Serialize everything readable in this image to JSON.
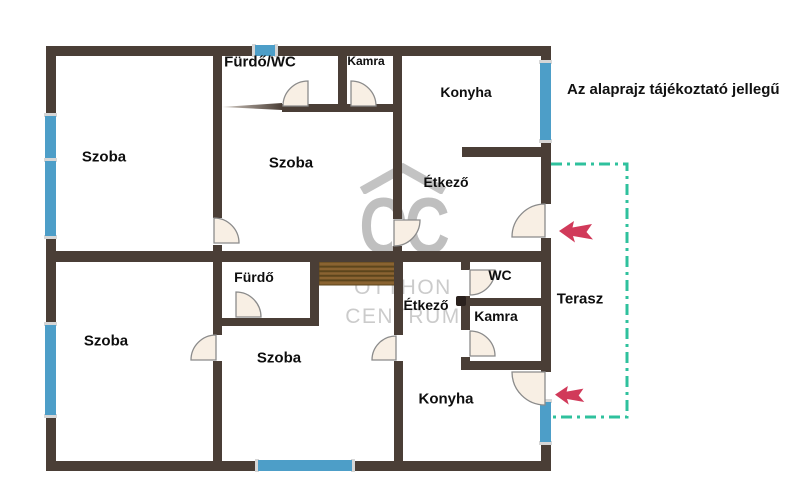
{
  "canvas": {
    "width": 808,
    "height": 500,
    "background": "#ffffff"
  },
  "disclaimer": "Az alaprajz tájékoztató jellegű",
  "watermark": {
    "monogram": "OC",
    "line1": "OTTHON",
    "line2": "CENTRUM"
  },
  "colors": {
    "wall": "#4a3e36",
    "window": "#4d9ec8",
    "window_cap": "#d6d6d6",
    "door_fill": "#f8efe4",
    "door_stroke": "#8b8b8b",
    "terrace": "#2fc19d",
    "arrow": "#d13a5a",
    "stairs": "#8a6331",
    "stairs_line": "#5c451c",
    "watermark": "#b9b9b9",
    "label": "#0e0e0e",
    "dot": "#2a211d"
  },
  "plan": {
    "walls": [
      {
        "id": "outer-top",
        "x": 46,
        "y": 46,
        "w": 505,
        "h": 10
      },
      {
        "id": "outer-bottom",
        "x": 46,
        "y": 461,
        "w": 505,
        "h": 10
      },
      {
        "id": "outer-left",
        "x": 46,
        "y": 46,
        "w": 10,
        "h": 425
      },
      {
        "id": "outer-right",
        "x": 541,
        "y": 46,
        "w": 10,
        "h": 425
      },
      {
        "id": "mid",
        "x": 46,
        "y": 251,
        "w": 505,
        "h": 11
      },
      {
        "id": "upper-left-room-divider",
        "x": 213,
        "y": 56,
        "w": 9,
        "h": 195
      },
      {
        "id": "bath-bottom",
        "x": 282,
        "y": 104,
        "w": 120,
        "h": 8
      },
      {
        "id": "bath-kamra-divider",
        "x": 338,
        "y": 56,
        "w": 9,
        "h": 56
      },
      {
        "id": "upper-right-room-divider",
        "x": 393,
        "y": 56,
        "w": 9,
        "h": 195
      },
      {
        "id": "konyha-etkezo-stub",
        "x": 462,
        "y": 147,
        "w": 89,
        "h": 10
      },
      {
        "id": "lower-left-room-divider",
        "x": 213,
        "y": 262,
        "w": 9,
        "h": 199
      },
      {
        "id": "furdo-right",
        "x": 310,
        "y": 262,
        "w": 9,
        "h": 64
      },
      {
        "id": "furdo-bottom",
        "x": 213,
        "y": 318,
        "w": 106,
        "h": 8
      },
      {
        "id": "lower-right-room-divider",
        "x": 394,
        "y": 262,
        "w": 9,
        "h": 199
      },
      {
        "id": "wc-kamra-left",
        "x": 461,
        "y": 262,
        "w": 9,
        "h": 108
      },
      {
        "id": "wc-kamra-divider",
        "x": 461,
        "y": 298,
        "w": 80,
        "h": 8
      },
      {
        "id": "kamra-bottom",
        "x": 461,
        "y": 361,
        "w": 90,
        "h": 9
      }
    ],
    "openings": [
      {
        "id": "etkezo-terrace-door-gap",
        "x": 540,
        "y": 204,
        "w": 12,
        "h": 34
      },
      {
        "id": "konyha-terrace-door-gap",
        "x": 540,
        "y": 372,
        "w": 12,
        "h": 30
      },
      {
        "id": "upper-szoba-door-gap",
        "x": 212,
        "y": 218,
        "w": 11,
        "h": 27
      },
      {
        "id": "etkezo-door-gap",
        "x": 392,
        "y": 219,
        "w": 11,
        "h": 27
      },
      {
        "id": "lower-left-szoba-door-gap",
        "x": 212,
        "y": 335,
        "w": 11,
        "h": 26
      },
      {
        "id": "lower-mid-szoba-door-gap",
        "x": 393,
        "y": 335,
        "w": 11,
        "h": 26
      },
      {
        "id": "wc-door-gap",
        "x": 460,
        "y": 270,
        "w": 11,
        "h": 26
      },
      {
        "id": "kamra-lower-door-gap",
        "x": 460,
        "y": 330,
        "w": 11,
        "h": 27
      }
    ],
    "windows": [
      {
        "id": "window-top",
        "x": 255,
        "y": 45,
        "w": 20,
        "h": 11,
        "dir": "h"
      },
      {
        "id": "window-left-1",
        "x": 45,
        "y": 116,
        "w": 11,
        "h": 43,
        "dir": "v"
      },
      {
        "id": "window-left-2",
        "x": 45,
        "y": 161,
        "w": 11,
        "h": 75,
        "dir": "v"
      },
      {
        "id": "window-left-3",
        "x": 45,
        "y": 325,
        "w": 11,
        "h": 90,
        "dir": "v"
      },
      {
        "id": "window-right-1",
        "x": 540,
        "y": 63,
        "w": 11,
        "h": 77,
        "dir": "v"
      },
      {
        "id": "window-right-2",
        "x": 540,
        "y": 402,
        "w": 11,
        "h": 40,
        "dir": "v"
      },
      {
        "id": "window-bottom",
        "x": 258,
        "y": 460,
        "w": 94,
        "h": 11,
        "dir": "h"
      }
    ],
    "doors": [
      {
        "id": "furdo-wc-top",
        "hx": 308,
        "hy": 106,
        "r": 25,
        "a1": 180,
        "a2": 270
      },
      {
        "id": "kamra-top",
        "hx": 351,
        "hy": 106,
        "r": 25,
        "a1": 270,
        "a2": 360
      },
      {
        "id": "upper-szoba",
        "hx": 214,
        "hy": 243,
        "r": 25,
        "a1": 270,
        "a2": 360
      },
      {
        "id": "etkezo-upper",
        "hx": 394,
        "hy": 220,
        "r": 26,
        "a1": 0,
        "a2": 90
      },
      {
        "id": "etkezo-terrace",
        "hx": 545,
        "hy": 237,
        "r": 33,
        "a1": 180,
        "a2": 270
      },
      {
        "id": "lower-left-szoba",
        "hx": 216,
        "hy": 360,
        "r": 25,
        "a1": 180,
        "a2": 270
      },
      {
        "id": "furdo-lower",
        "hx": 236,
        "hy": 317,
        "r": 25,
        "a1": 270,
        "a2": 360
      },
      {
        "id": "lower-mid-szoba",
        "hx": 396,
        "hy": 360,
        "r": 24,
        "a1": 180,
        "a2": 270
      },
      {
        "id": "wc",
        "hx": 470,
        "hy": 270,
        "r": 25,
        "a1": 0,
        "a2": 90
      },
      {
        "id": "kamra-lower",
        "hx": 470,
        "hy": 356,
        "r": 25,
        "a1": 270,
        "a2": 360
      },
      {
        "id": "konyha-terrace",
        "hx": 545,
        "hy": 372,
        "r": 33,
        "a1": 90,
        "a2": 180
      }
    ],
    "stairs": {
      "x": 319,
      "y": 262,
      "w": 76,
      "h": 23,
      "slats": 4
    },
    "post_dot": {
      "x": 456,
      "y": 296,
      "w": 10,
      "h": 10
    },
    "taper_line": {
      "x1": 222,
      "y1": 107,
      "x2": 282,
      "y2": 103,
      "y3": 110
    },
    "terrace": {
      "points": "551,164 627,164 627,417 551,417",
      "dash": "11 5 3 5"
    },
    "arrows": [
      {
        "id": "entrance-arrow-upper",
        "x": 559,
        "y": 221,
        "w": 36,
        "h": 22
      },
      {
        "id": "entrance-arrow-lower",
        "x": 555,
        "y": 386,
        "w": 31,
        "h": 19
      }
    ],
    "rooms": [
      {
        "id": "szoba-upper-left",
        "label": "Szoba",
        "x": 104,
        "y": 157,
        "size": 15
      },
      {
        "id": "szoba-upper-middle",
        "label": "Szoba",
        "x": 291,
        "y": 163,
        "size": 15
      },
      {
        "id": "furdo-wc",
        "label": "Fürdő/WC",
        "x": 260,
        "y": 62,
        "size": 15
      },
      {
        "id": "kamra-upper",
        "label": "Kamra",
        "x": 366,
        "y": 61,
        "size": 12
      },
      {
        "id": "konyha-upper",
        "label": "Konyha",
        "x": 466,
        "y": 92,
        "size": 14
      },
      {
        "id": "etkezo-upper",
        "label": "Étkező",
        "x": 446,
        "y": 182,
        "size": 14
      },
      {
        "id": "szoba-lower-left",
        "label": "Szoba",
        "x": 106,
        "y": 341,
        "size": 15
      },
      {
        "id": "furdo-lower",
        "label": "Fürdő",
        "x": 254,
        "y": 277,
        "size": 14
      },
      {
        "id": "szoba-lower-middle",
        "label": "Szoba",
        "x": 279,
        "y": 358,
        "size": 15
      },
      {
        "id": "etkezo-lower",
        "label": "Étkező",
        "x": 426,
        "y": 305,
        "size": 14
      },
      {
        "id": "wc",
        "label": "WC",
        "x": 500,
        "y": 275,
        "size": 14
      },
      {
        "id": "kamra-lower",
        "label": "Kamra",
        "x": 496,
        "y": 316,
        "size": 14
      },
      {
        "id": "konyha-lower",
        "label": "Konyha",
        "x": 446,
        "y": 399,
        "size": 15
      },
      {
        "id": "terasz",
        "label": "Terasz",
        "x": 580,
        "y": 299,
        "size": 15
      }
    ]
  }
}
